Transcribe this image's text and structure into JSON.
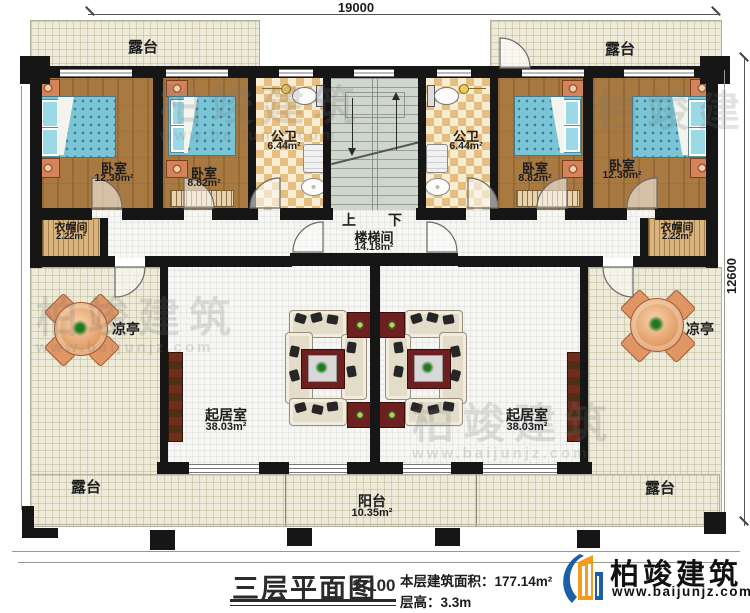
{
  "dimensions": {
    "top": "19000",
    "right": "12600"
  },
  "rooms": {
    "terrace_top_left": "露台",
    "terrace_top_right": "露台",
    "terrace_bottom_left": "露台",
    "terrace_bottom_right": "露台",
    "bedroom_l1": {
      "name": "卧室",
      "area": "12.30m²"
    },
    "bedroom_l2": {
      "name": "卧室",
      "area": "8.82m²"
    },
    "bedroom_r2": {
      "name": "卧室",
      "area": "8.82m²"
    },
    "bedroom_r1": {
      "name": "卧室",
      "area": "12.30m²"
    },
    "bath_left": {
      "name": "公卫",
      "area": "6.44m²"
    },
    "bath_right": {
      "name": "公卫",
      "area": "6.44m²"
    },
    "wic_left": {
      "name": "衣帽间",
      "area": "2.22m²"
    },
    "wic_right": {
      "name": "衣帽间",
      "area": "2.22m²"
    },
    "stairwell": {
      "name": "楼梯间",
      "area": "14.18m²",
      "up": "上",
      "down": "下"
    },
    "pavilion_left": "凉亭",
    "pavilion_right": "凉亭",
    "living_left": {
      "name": "起居室",
      "area": "38.03m²"
    },
    "living_right": {
      "name": "起居室",
      "area": "38.03m²"
    },
    "balcony": {
      "name": "阳台",
      "area": "10.35m²"
    }
  },
  "title_block": {
    "title": "三层平面图",
    "scale": "1:100",
    "floor_area": "本层建筑面积：177.14m²",
    "floor_height": "层高：3.3m"
  },
  "brand": {
    "name": "柏竣建筑",
    "website": "www.baijunjz.com"
  },
  "watermark": {
    "text": "柏竣建筑",
    "sub": "www.baijunjz.com"
  }
}
